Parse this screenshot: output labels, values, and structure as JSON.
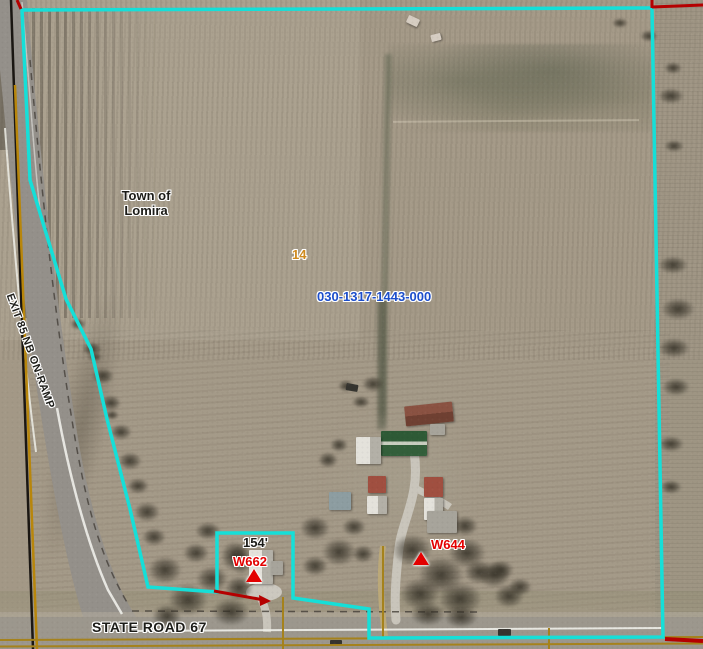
{
  "labels": {
    "municipality_line1": "Town of",
    "municipality_line2": "Lomira",
    "section_number": "14",
    "parcel_id": "030-1317-1443-000",
    "lot_dimension": "154'",
    "address_w662": "W662",
    "address_w644": "W644",
    "road_state": "STATE ROAD 67",
    "road_ramp": "EXIT 85 NB ON-RAMP"
  },
  "colors": {
    "parcel_boundary": "#15dfd8",
    "adjacent_parcel_line": "#b50000",
    "parcel_id_text": "#1c4ecb",
    "section_number_text": "#cf8a1e",
    "address_point_text": "#e30000",
    "road_label_text": "#1c1c18",
    "overlay_road_line_black": "#1a1612",
    "overlay_road_line_yellow": "#b8860b"
  }
}
